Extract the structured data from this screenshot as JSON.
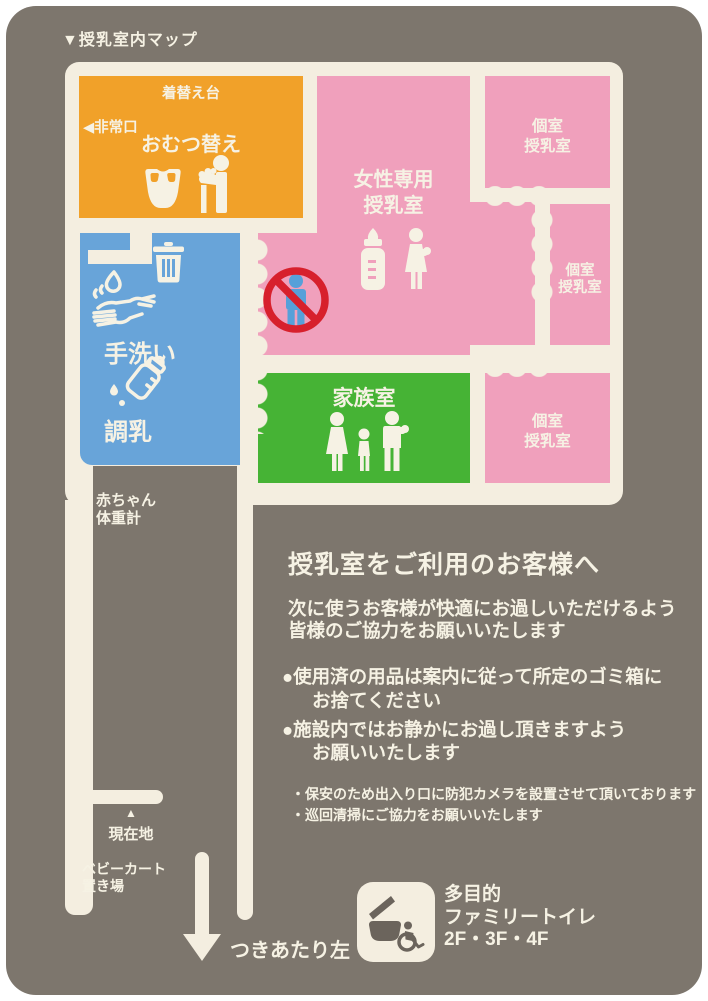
{
  "title": "▼授乳室内マップ",
  "map": {
    "diaper_room": {
      "name_label": "おむつ替え",
      "changing_table_label": "着替え台",
      "emergency_exit_label": "◀非常口"
    },
    "women_nursing_room": {
      "line1": "女性専用",
      "line2": "授乳室"
    },
    "private_nursing_room": {
      "line1": "個室",
      "line2": "授乳室"
    },
    "family_room": {
      "label": "家族室"
    },
    "handwash_label": "手洗い",
    "milk_prep_label": "調乳",
    "baby_scale": {
      "line1": "赤ちゃん",
      "line2": "体重計"
    },
    "current_location": {
      "marker": "▲",
      "label": "現在地"
    },
    "stroller_parking": {
      "line1": "ベビーカート",
      "line2": "置き場"
    },
    "exit_direction_label": "つきあたり左"
  },
  "notice": {
    "heading": "授乳室をご利用のお客様へ",
    "intro_line1": "次に使うお客様が快適にお過しいただけるよう",
    "intro_line2": "皆様のご協力をお願いいたします",
    "bullet1_line1": "●使用済の用品は案内に従って所定のゴミ箱に",
    "bullet1_line2": "お捨てください",
    "bullet2_line1": "●施設内ではお静かにお過し頂きますよう",
    "bullet2_line2": "お願いいたします",
    "note1": "・保安のため出入り口に防犯カメラを設置させて頂いております",
    "note2": "・巡回清掃にご協力をお願いいたします"
  },
  "toilet_info": {
    "line1": "多目的",
    "line2": "ファミリートイレ",
    "line3": "2F・3F・4F"
  },
  "icons": {
    "diaper": "diaper-icon",
    "person_changing_baby": "person-changing-baby-icon",
    "trash": "trash-icon",
    "handwash": "handwash-icon",
    "milk_prep_bottle": "bottle-drops-icon",
    "no_men": "no-men-icon",
    "baby_bottle": "baby-bottle-icon",
    "mother_holding_baby": "mother-holding-baby-icon",
    "family": "family-icon",
    "down_arrow": "down-arrow-icon",
    "multipurpose_toilet": "toilet-wheelchair-icon"
  },
  "colors": {
    "background": "#7d766d",
    "wall": "#f4eee0",
    "diaper_room": "#f1a129",
    "nursing_room": "#f0a0bc",
    "washing_area": "#68a4d9",
    "family_room": "#46b335",
    "prohibition_red": "#d7202c",
    "prohibition_figure": "#56a0d9"
  }
}
